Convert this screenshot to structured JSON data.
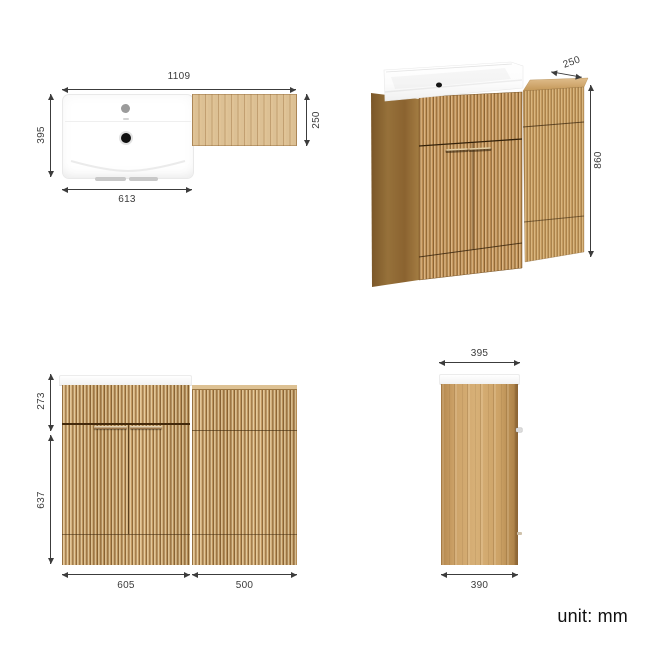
{
  "title": "bathroom-vanity-dimension-diagram",
  "unit_label": "unit: mm",
  "dimensions": {
    "top_view": {
      "overall_width": "1109",
      "basin_depth": "395",
      "basin_width": "613",
      "wc_unit_depth": "250"
    },
    "perspective_view": {
      "wc_top_depth": "250",
      "overall_height": "860"
    },
    "front_view": {
      "upper_section_height": "273",
      "lower_section_height": "637",
      "vanity_width": "605",
      "wc_unit_width": "500"
    },
    "side_view": {
      "top_depth": "395",
      "base_depth": "390"
    }
  },
  "colors": {
    "dimension_line": "#3c3c3c",
    "wood_light": "#d9b583",
    "wood_dark": "#8d6634",
    "basin_white": "#ffffff",
    "background": "#ffffff"
  }
}
